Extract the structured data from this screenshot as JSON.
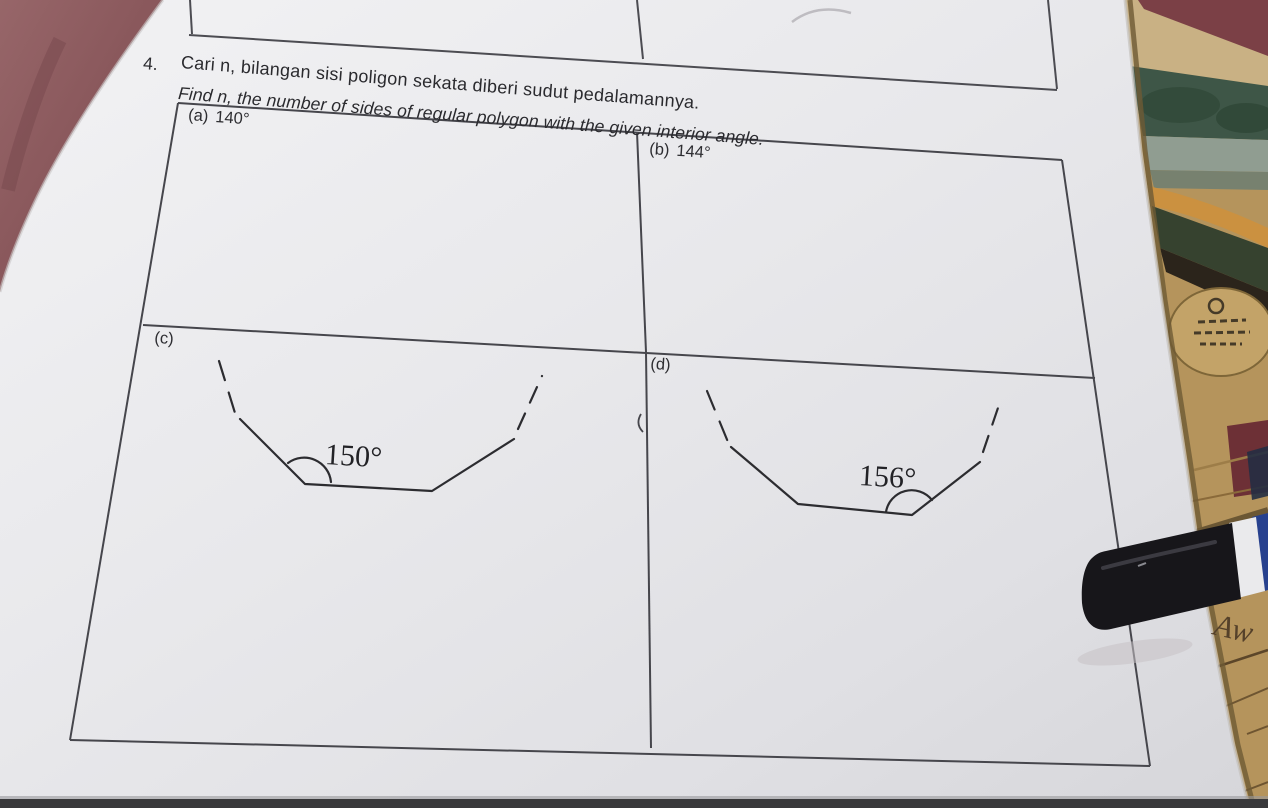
{
  "document": {
    "question_number": "4.",
    "prompt_malay": "Cari n, bilangan sisi poligon sekata diberi sudut pedalamannya.",
    "prompt_english": "Find n, the number of sides of regular polygon with the given interior angle.",
    "parts": [
      {
        "id": "a",
        "label": "(a)",
        "angle": "140°"
      },
      {
        "id": "b",
        "label": "(b)",
        "angle": "144°"
      },
      {
        "id": "c",
        "label": "(c)",
        "angle": "150°"
      },
      {
        "id": "d",
        "label": "(d)",
        "angle": "156°"
      }
    ]
  },
  "annotations": {
    "handwriting": "Aw"
  },
  "colors": {
    "paper": "#e9e9ec",
    "table_line": "#46464c",
    "figure_line": "#2c2c30",
    "fabric_maroon": "#8a575b",
    "cardboard_tan": "#b5945c",
    "photo_green": "#3e5647",
    "photo_orange": "#cb9140",
    "red_patch": "#6d3036",
    "pen_black": "#17161a",
    "pen_white": "#eaeaec",
    "pen_blue": "#27418e",
    "handwriting_brown": "#55412a"
  }
}
